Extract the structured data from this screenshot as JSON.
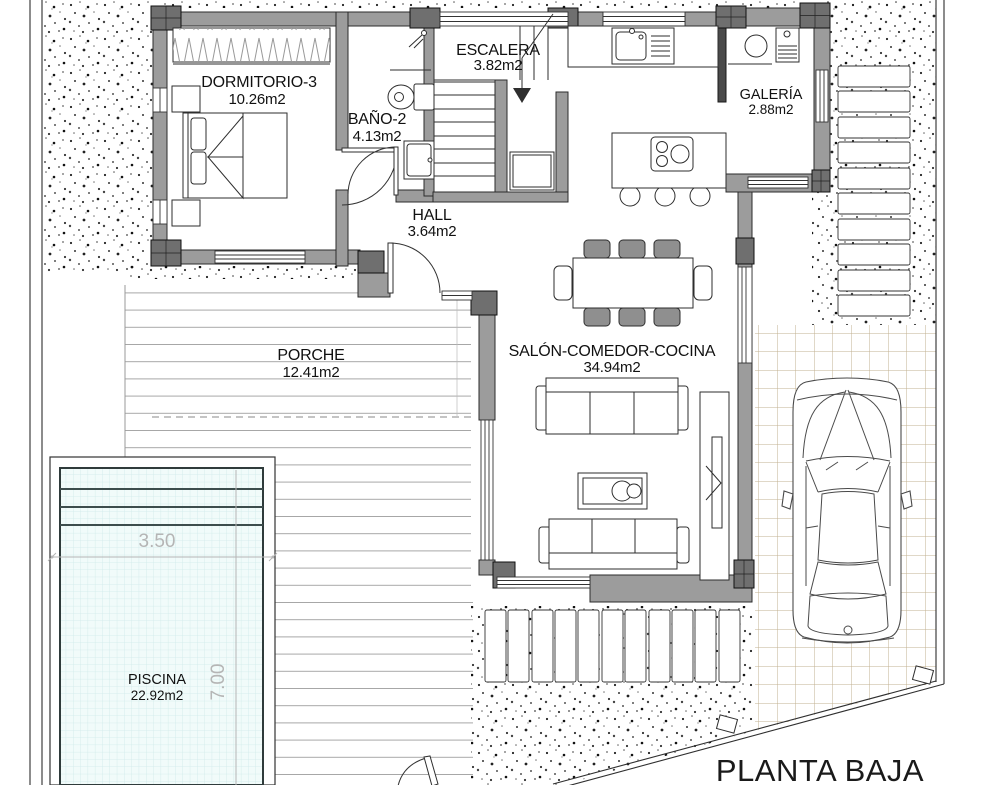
{
  "title": "PLANTA BAJA",
  "rooms": [
    {
      "name": "DORMITORIO-3",
      "area": "10.26m2"
    },
    {
      "name": "BAÑO-2",
      "area": "4.13m2"
    },
    {
      "name": "ESCALERA",
      "area": "3.82m2"
    },
    {
      "name": "GALERÍA",
      "area": "2.88m2"
    },
    {
      "name": "HALL",
      "area": "3.64m2"
    },
    {
      "name": "PORCHE",
      "area": "12.41m2"
    },
    {
      "name": "SALÓN-COMEDOR-COCINA",
      "area": "34.94m2"
    },
    {
      "name": "PISCINA",
      "area": "22.92m2"
    }
  ],
  "pool_dimensions": {
    "width": "3.50",
    "length": "7.00"
  },
  "colors": {
    "wall": "#9c9c9c",
    "wall_column": "#6f6f6f",
    "outline": "#2b2b2b",
    "pool_water": "#f1fbfa",
    "pool_grid": "#cfeaea",
    "tile_line": "#c2b191",
    "deck_line": "#a6a6a6",
    "dimension_text": "#b5b5b5"
  }
}
